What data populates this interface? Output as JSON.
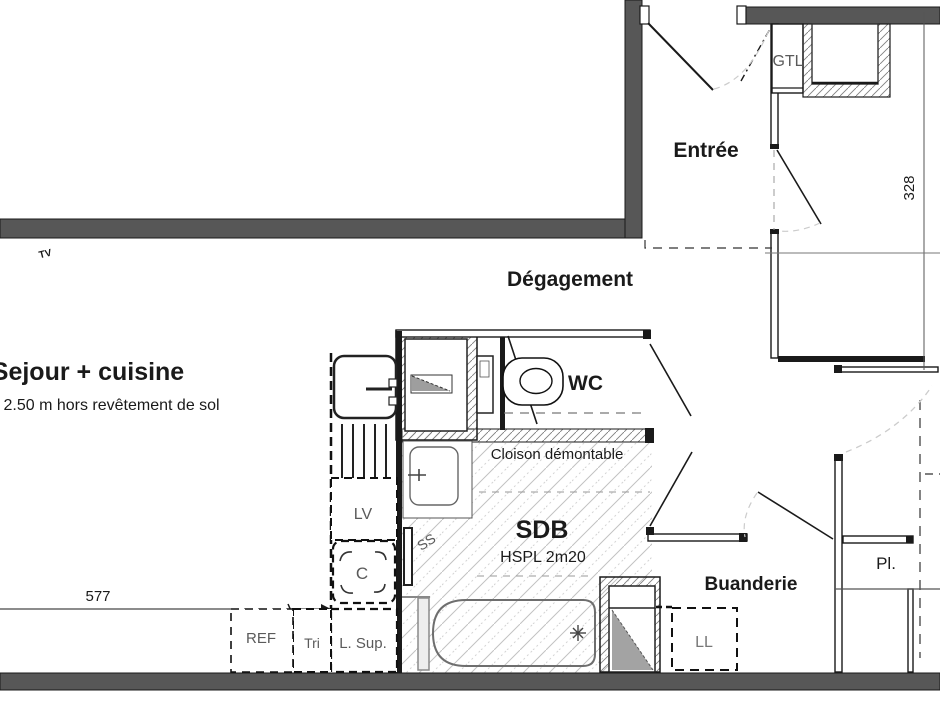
{
  "plan": {
    "title_note": "Floor plan (apartment)",
    "rooms": {
      "sejour": "Sejour + cuisine",
      "entree": "Entrée",
      "degagement": "Dégagement",
      "wc": "WC",
      "sdb": "SDB",
      "buanderie": "Buanderie",
      "placard": "Pl.",
      "gtl": "GTL"
    },
    "annotations": {
      "ceiling_note": "' 2.50 m hors revêtement de sol",
      "cloison": "Cloison démontable",
      "hspl": "HSPL 2m20",
      "ss": "SS",
      "tv": "TV"
    },
    "fixtures": {
      "lv": "LV",
      "hob": "C",
      "ref": "REF",
      "tri": "Tri",
      "l_sup": "L. Sup.",
      "ll": "LL"
    },
    "dimensions": {
      "width_cm": "577",
      "height_cm": "328"
    },
    "colors": {
      "wall": "#575757",
      "line": "#1a1a1a",
      "dense_hatch": "#808080",
      "floor_hatch": "#c2c2c2",
      "duct_fill": "#a3a3a3",
      "label_gray": "#5a5a5a"
    }
  }
}
